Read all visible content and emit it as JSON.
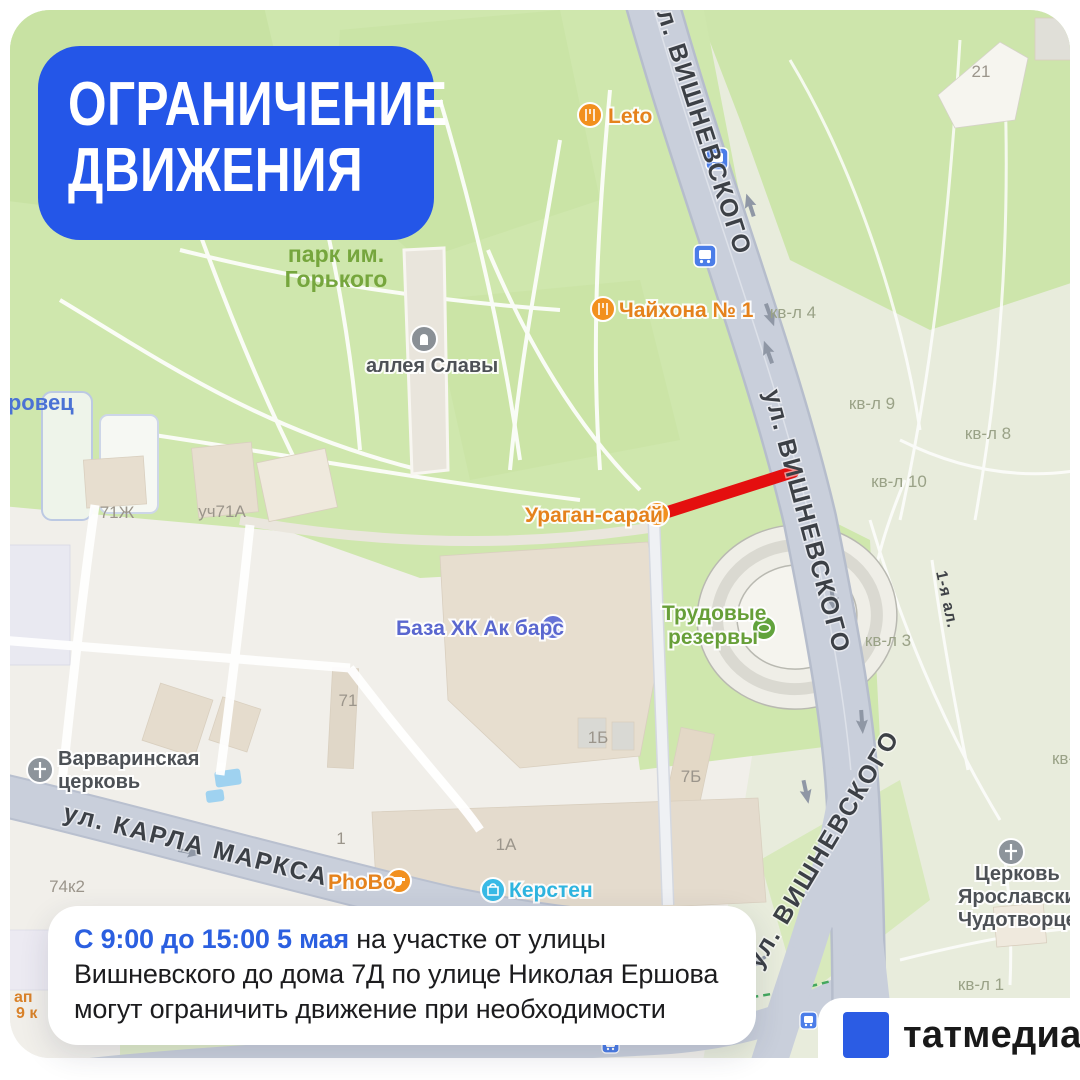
{
  "badge": {
    "line1": "ОГРАНИЧЕНИЕ",
    "line2": "ДВИЖЕНИЯ",
    "bg_color": "#2456e8"
  },
  "notice": {
    "highlight": "С 9:00 до 15:00 5 мая",
    "line1_rest": " на участке от улицы",
    "line2": "Вишневского до дома 7Д по улице Николая Ершова",
    "line3": "могут ограничить движение при необходимости",
    "highlight_color": "#2b5fe0"
  },
  "logo": {
    "name": "татмедиа",
    "square_color": "#2b5ce4"
  },
  "map": {
    "restriction_color": "#e40f0f",
    "streets": {
      "vishnevskogo_top": "ул. ВИШНЕВСКОГО",
      "vishnevskogo_mid": "ул. ВИШНЕВСКОГО",
      "vishnevskogo_bottom": "ул. ВИШНЕВСКОГО",
      "karla_marksa": "ул. КАРЛА МАРКСА",
      "alley_1": "1-я ал."
    },
    "park_label": {
      "line1": "парк им.",
      "line2": "Горького"
    },
    "poi": {
      "leto": "Leto",
      "chaihona": "Чайхона № 1",
      "uragan": "Ураган-сарай",
      "akbars": "База ХК Ак барс",
      "trudovye_line1": "Трудовые",
      "trudovye_line2": "резервы",
      "varvara_line1": "Варваринская",
      "varvara_line2": "церковь",
      "alleya_slavy": "аллея Славы",
      "phobo": "PhoBo",
      "kersten": "Керстен",
      "church_yar_line1": "Церковь",
      "church_yar_line2": "Ярославских",
      "church_yar_line3": "Чудотворцев",
      "zorovets": "зоровец",
      "partial_left_line1": "ап",
      "partial_left_line2": "9 к"
    },
    "quarters": {
      "kvl4": "кв-л 4",
      "kvl9": "кв-л 9",
      "kvl8": "кв-л 8",
      "kvl10": "кв-л 10",
      "kvl3": "кв-л 3",
      "kvl1": "кв-л 1",
      "kv_edge": "кв-л"
    },
    "houses": {
      "n21": "21",
      "n71zh": "71Ж",
      "uch71a": "уч71А",
      "n71": "71",
      "n1b": "1Б",
      "n7b": "7Б",
      "n1a": "1А",
      "n1": "1",
      "n74k2": "74к2"
    }
  }
}
